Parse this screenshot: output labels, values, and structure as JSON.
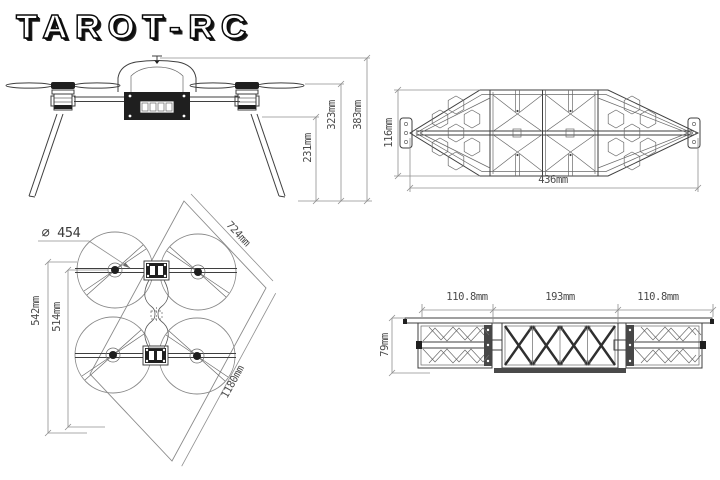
{
  "logo": {
    "text": "TAROT-RC"
  },
  "views": {
    "side": {
      "name": "drone side view",
      "dims": {
        "leg_height": "231mm",
        "prop_height": "323mm",
        "overall_height": "383mm"
      }
    },
    "frame_top": {
      "name": "frame top view",
      "dims": {
        "height": "116mm",
        "width": "436mm"
      }
    },
    "quad_top": {
      "name": "quadcopter top view",
      "dims": {
        "prop_diameter": "∅ 454",
        "frame_diagonal": "724mm",
        "overall_diagonal": "1180mm",
        "outer_span": "542mm",
        "inner_span": "514mm"
      }
    },
    "frame_side": {
      "name": "frame side view",
      "dims": {
        "left_section": "110.8mm",
        "center_section": "193mm",
        "right_section": "110.8mm",
        "height": "79mm"
      }
    }
  },
  "colors": {
    "line": "#3f3f3f",
    "dim_line": "#8f8f8f",
    "dim_text": "#4a4a4a",
    "dark_fill": "#1f1f1f"
  }
}
